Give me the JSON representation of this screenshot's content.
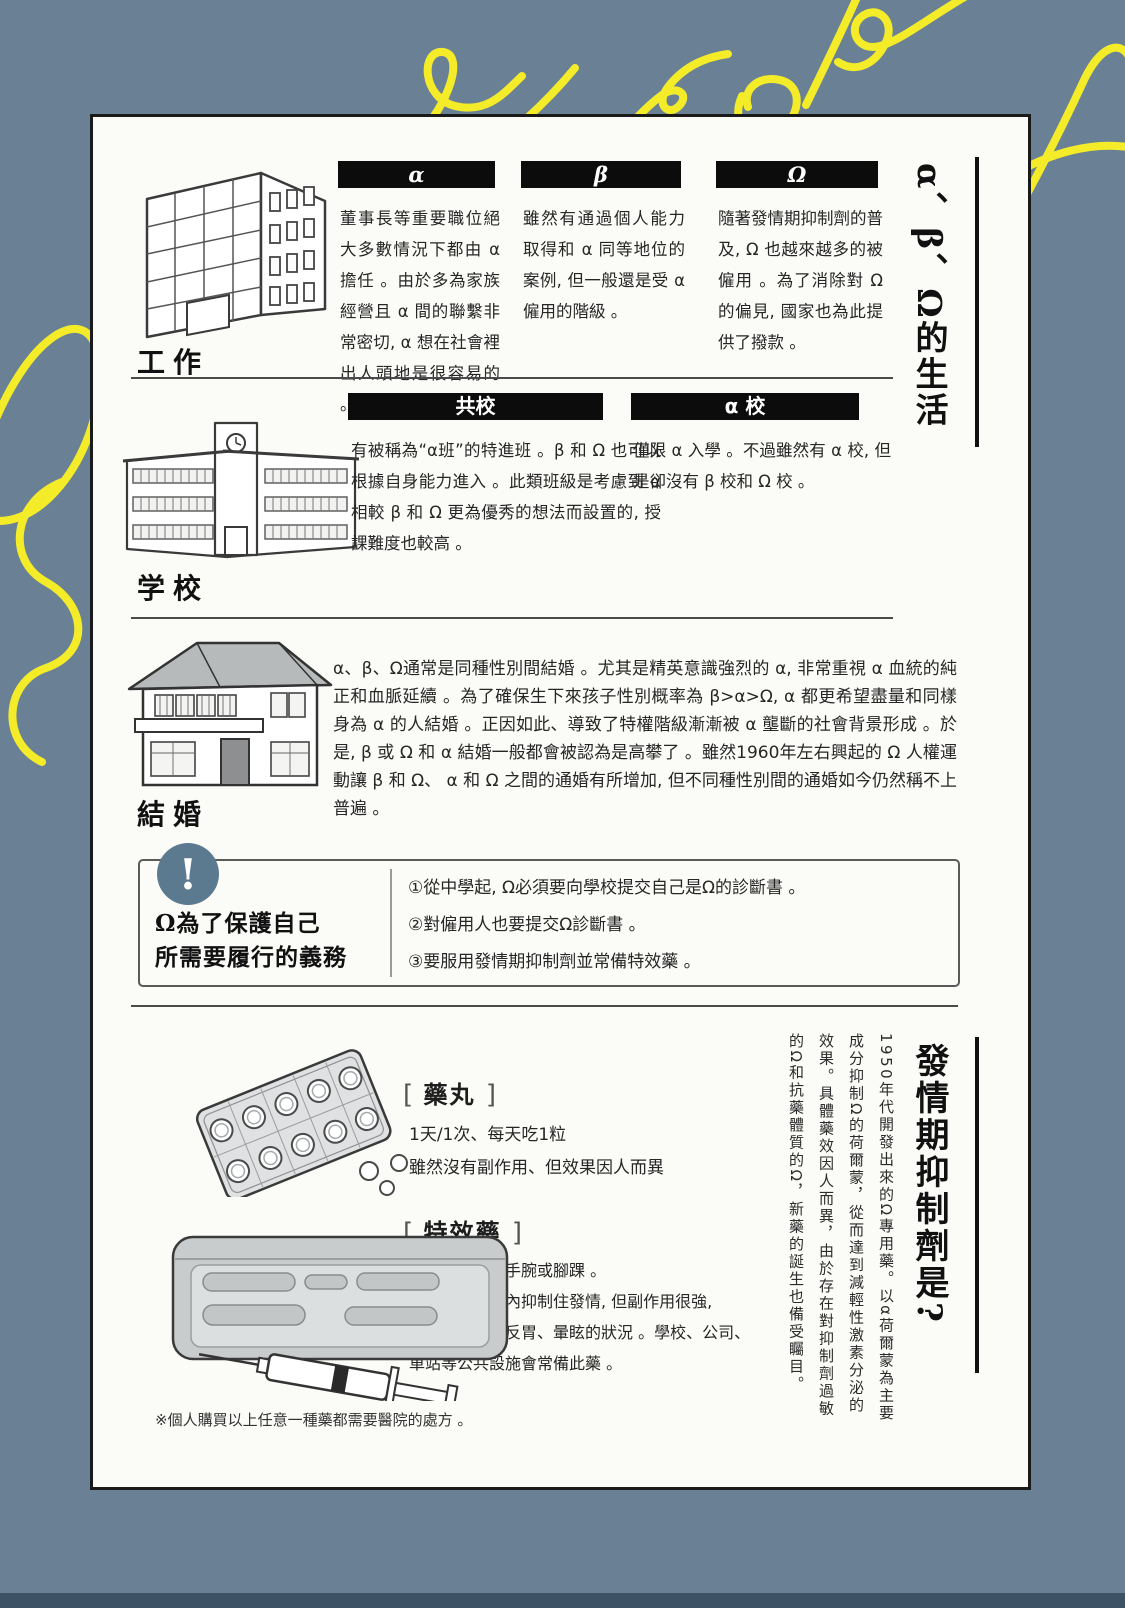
{
  "page": {
    "bg_color": "#698095",
    "card_bg": "#fbfbf8",
    "accent_yellow": "#f4ec29",
    "alert_blue": "#5b7a90",
    "alert_icon": "!"
  },
  "life": {
    "title": "α、β、Ω的生活",
    "work": {
      "label": "工作",
      "columns": [
        {
          "header": "α",
          "text": "董事長等重要職位絕大多數情況下都由 α 擔任 。由於多為家族經營且 α 間的聯繫非常密切, α 想在社會裡出人頭地是很容易的 。"
        },
        {
          "header": "β",
          "text": "雖然有通過個人能力取得和 α 同等地位的案例, 但一般還是受 α 僱用的階級 。"
        },
        {
          "header": "Ω",
          "text": "隨著發情期抑制劑的普及, Ω 也越來越多的被僱用 。為了消除對 Ω 的偏見, 國家也為此提供了撥款 。"
        }
      ]
    },
    "school": {
      "label": "学校",
      "columns": [
        {
          "header": "共校",
          "text": "有被稱為“α班”的特進班 。β 和 Ω 也可以根據自身能力進入 。此類班級是考慮到 α 相較 β 和 Ω 更為優秀的想法而設置的, 授課難度也較高 。"
        },
        {
          "header": "α 校",
          "text": "僅限 α 入學 。不過雖然有 α 校, 但是卻沒有 β 校和 Ω 校 。"
        }
      ]
    },
    "marriage": {
      "label": "結婚",
      "text": "α、β、Ω通常是同種性別間結婚 。尤其是精英意識強烈的 α, 非常重視 α 血統的純正和血脈延續 。為了確保生下來孩子性別概率為 β>α>Ω, α 都更希望盡量和同樣身為 α 的人結婚 。正因如此、導致了特權階級漸漸被 α 壟斷的社會背景形成 。於是, β 或 Ω 和 α 結婚一般都會被認為是高攀了 。雖然1960年左右興起的 Ω 人權運動讓 β 和 Ω、 α 和 Ω 之間的通婚有所增加, 但不同種性別間的通婚如今仍然稱不上普遍 。"
    },
    "obligations": {
      "title_line1": "Ω為了保護自己",
      "title_line2": "所需要履行的義務",
      "items": [
        "①從中學起, Ω必須要向學校提交自己是Ω的診斷書 。",
        "②對僱用人也要提交Ω診斷書 。",
        "③要服用發情期抑制劑並常備特效藥 。"
      ]
    }
  },
  "suppressant": {
    "title": "發情期抑制劑是?",
    "body_vertical": "1950年代開發出來的Ω專用藥。以α荷爾蒙為主要成分抑制Ω的荷爾蒙，從而達到減輕性激素分泌的效果。具體藥效因人而異，由於存在對抑制劑過敏的Ω和抗藥體質的Ω，新藥的誕生也備受矚目。",
    "pill": {
      "bracket_open": "[",
      "header": "藥丸",
      "bracket_close": "]",
      "lines": [
        "1天/1次、每天吃1粒",
        "雖然沒有副作用、但效果因人而異"
      ]
    },
    "injection": {
      "bracket_open": "[",
      "header": "特效藥",
      "bracket_close": "]",
      "lines": [
        "發情期注射進手腕或腳踝 。",
        "可以在五分鐘內抑制住發情, 但副作用很強,",
        "會出現頭痛、反胃、暈眩的狀況 。學校、公司、",
        "車站等公共設施會常備此藥 。"
      ]
    },
    "note": "※個人購買以上任意一種藥都需要醫院的處方 。"
  }
}
